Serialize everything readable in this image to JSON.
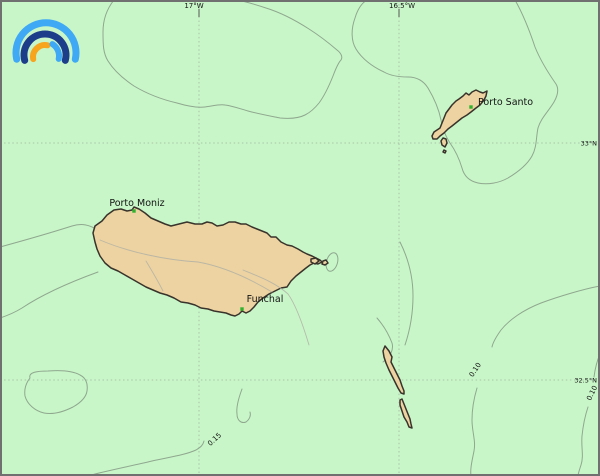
{
  "colors": {
    "sea": "#c8f6c8",
    "land": "#edd3a1",
    "coast": "#38332b",
    "contour": "#8fa78f",
    "inland": "#b2b2a6",
    "grid": "#9ab09a",
    "tick": "#555555",
    "text": "#141414",
    "city_dot": "#2fb22f",
    "frame": "#707070",
    "logo_light_blue": "#3fa9f5",
    "logo_dark_blue": "#1c3d8a",
    "logo_orange": "#f7a41f"
  },
  "axes": {
    "top": [
      {
        "label": "17°W"
      },
      {
        "label": "16.5°W"
      }
    ],
    "right": [
      {
        "label": "33°N"
      },
      {
        "label": "32.5°N"
      }
    ]
  },
  "places": [
    {
      "name": "Porto Moniz"
    },
    {
      "name": "Funchal"
    },
    {
      "name": "Porto Santo"
    }
  ],
  "contours": [
    {
      "value": "0.10"
    },
    {
      "value": "0.15"
    },
    {
      "value": "0.10"
    }
  ]
}
